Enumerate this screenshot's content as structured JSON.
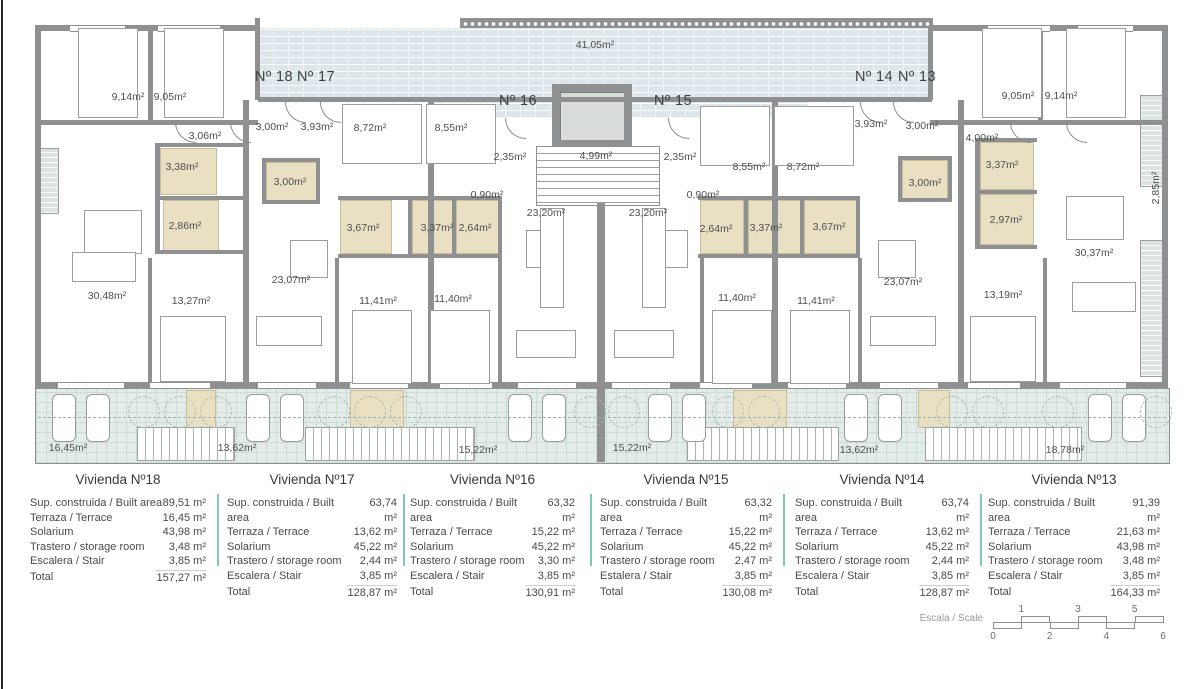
{
  "plan": {
    "labels": [
      {
        "t": "41,05m²",
        "x": 595,
        "y": 45
      },
      {
        "t": "Nº 18",
        "x": 274,
        "y": 77,
        "big": true
      },
      {
        "t": "Nº 17",
        "x": 316,
        "y": 77,
        "big": true
      },
      {
        "t": "Nº 16",
        "x": 518,
        "y": 101,
        "big": true
      },
      {
        "t": "Nº 15",
        "x": 673,
        "y": 101,
        "big": true
      },
      {
        "t": "Nº 14",
        "x": 874,
        "y": 77,
        "big": true
      },
      {
        "t": "Nº 13",
        "x": 917,
        "y": 77,
        "big": true
      },
      {
        "t": "9,14m²",
        "x": 128,
        "y": 97
      },
      {
        "t": "9,05m²",
        "x": 170,
        "y": 97
      },
      {
        "t": "3,06m²",
        "x": 205,
        "y": 136
      },
      {
        "t": "3,00m²",
        "x": 272,
        "y": 127
      },
      {
        "t": "3,93m²",
        "x": 317,
        "y": 127
      },
      {
        "t": "8,72m²",
        "x": 370,
        "y": 128
      },
      {
        "t": "8,55m²",
        "x": 451,
        "y": 128
      },
      {
        "t": "2,35m²",
        "x": 510,
        "y": 157
      },
      {
        "t": "4,99m²",
        "x": 596,
        "y": 156
      },
      {
        "t": "2,35m²",
        "x": 680,
        "y": 157
      },
      {
        "t": "8,55m²",
        "x": 749,
        "y": 167
      },
      {
        "t": "8,72m²",
        "x": 803,
        "y": 167
      },
      {
        "t": "3,93m²",
        "x": 871,
        "y": 124
      },
      {
        "t": "3,00m²",
        "x": 922,
        "y": 126
      },
      {
        "t": "4,00m²",
        "x": 982,
        "y": 138
      },
      {
        "t": "9,05m²",
        "x": 1018,
        "y": 96
      },
      {
        "t": "9,14m²",
        "x": 1061,
        "y": 96
      },
      {
        "t": "3,38m²",
        "x": 182,
        "y": 167
      },
      {
        "t": "3,00m²",
        "x": 290,
        "y": 182
      },
      {
        "t": "2,86m²",
        "x": 185,
        "y": 226
      },
      {
        "t": "3,67m²",
        "x": 363,
        "y": 228
      },
      {
        "t": "3,37m²",
        "x": 437,
        "y": 228
      },
      {
        "t": "2,64m²",
        "x": 475,
        "y": 228
      },
      {
        "t": "0,90m²",
        "x": 487,
        "y": 195
      },
      {
        "t": "23,20m²",
        "x": 546,
        "y": 213
      },
      {
        "t": "23,20m²",
        "x": 648,
        "y": 213
      },
      {
        "t": "0,90m²",
        "x": 703,
        "y": 195
      },
      {
        "t": "2,64m²",
        "x": 716,
        "y": 229
      },
      {
        "t": "3,37m²",
        "x": 766,
        "y": 228
      },
      {
        "t": "3,67m²",
        "x": 829,
        "y": 227
      },
      {
        "t": "3,37m²",
        "x": 1002,
        "y": 165
      },
      {
        "t": "3,00m²",
        "x": 925,
        "y": 183
      },
      {
        "t": "2,97m²",
        "x": 1006,
        "y": 220
      },
      {
        "t": "30,48m²",
        "x": 107,
        "y": 296
      },
      {
        "t": "13,27m²",
        "x": 191,
        "y": 301
      },
      {
        "t": "23,07m²",
        "x": 291,
        "y": 280
      },
      {
        "t": "11,41m²",
        "x": 378,
        "y": 301
      },
      {
        "t": "11,40m²",
        "x": 453,
        "y": 299
      },
      {
        "t": "11,40m²",
        "x": 737,
        "y": 298
      },
      {
        "t": "11,41m²",
        "x": 816,
        "y": 301
      },
      {
        "t": "23,07m²",
        "x": 903,
        "y": 282
      },
      {
        "t": "13,19m²",
        "x": 1003,
        "y": 295
      },
      {
        "t": "30,37m²",
        "x": 1094,
        "y": 253
      },
      {
        "t": "2,85m²",
        "x": 1156,
        "y": 188,
        "v": true
      },
      {
        "t": "16,45m²",
        "x": 68,
        "y": 448
      },
      {
        "t": "13,62m²",
        "x": 237,
        "y": 448
      },
      {
        "t": "15,22m²",
        "x": 478,
        "y": 450
      },
      {
        "t": "15,22m²",
        "x": 632,
        "y": 448
      },
      {
        "t": "13,62m²",
        "x": 859,
        "y": 450
      },
      {
        "t": "18,78m²",
        "x": 1065,
        "y": 450
      }
    ]
  },
  "units": [
    {
      "title": "Vivienda Nº18",
      "rows": [
        [
          "Sup. construida / Built area",
          "89,51 m²"
        ],
        [
          "Terraza / Terrace",
          "16,45 m²"
        ],
        [
          "Solarium",
          "43,98 m²"
        ],
        [
          "Trastero / storage room",
          "3,48 m²"
        ],
        [
          "Escalera / Stair",
          "3,85 m²"
        ],
        [
          "Total",
          "157,27 m²"
        ]
      ]
    },
    {
      "title": "Vivienda Nº17",
      "rows": [
        [
          "Sup. construida / Built area",
          "63,74 m²"
        ],
        [
          "Terraza / Terrace",
          "13,62 m²"
        ],
        [
          "Solarium",
          "45,22 m²"
        ],
        [
          "Trastero / storage room",
          "2,44 m²"
        ],
        [
          "Escalera / Stair",
          "3,85 m²"
        ],
        [
          "Total",
          "128,87 m²"
        ]
      ]
    },
    {
      "title": "Vivienda Nº16",
      "rows": [
        [
          "Sup. construida / Built area",
          "63,32 m²"
        ],
        [
          "Terraza / Terrace",
          "15,22 m²"
        ],
        [
          "Solarium",
          "45,22 m²"
        ],
        [
          "Trastero / storage room",
          "3,30 m²"
        ],
        [
          "Escalera / Stair",
          "3,85 m²"
        ],
        [
          "Total",
          "130,91 m²"
        ]
      ]
    },
    {
      "title": "Vivienda Nº15",
      "rows": [
        [
          "Sup. construida / Built area",
          "63,32 m²"
        ],
        [
          "Terraza / Terrace",
          "15,22 m²"
        ],
        [
          "Solarium",
          "45,22 m²"
        ],
        [
          "Trastero / storage room",
          "2,47 m²"
        ],
        [
          "Estalera / Stair",
          "3,85 m²"
        ],
        [
          "Total",
          "130,08 m²"
        ]
      ]
    },
    {
      "title": "Vivienda Nº14",
      "rows": [
        [
          "Sup. construida / Built area",
          "63,74 m²"
        ],
        [
          "Terraza / Terrace",
          "13,62 m²"
        ],
        [
          "Solarium",
          "45,22 m²"
        ],
        [
          "Trastero / storage room",
          "2,44 m²"
        ],
        [
          "Escalera / Stair",
          "3,85 m²"
        ],
        [
          "Total",
          "128,87 m²"
        ]
      ]
    },
    {
      "title": "Vivienda Nº13",
      "rows": [
        [
          "Sup. construida / Built area",
          "91,39 m²"
        ],
        [
          "Terraza / Terrace",
          "21,63 m²"
        ],
        [
          "Solarium",
          "43,98 m²"
        ],
        [
          "Trastero / storage room",
          "3,48 m²"
        ],
        [
          "Escalera / Stair",
          "3,85 m²"
        ],
        [
          "Total",
          "164,33 m²"
        ]
      ]
    }
  ],
  "scale": {
    "label": "Escala / Scale",
    "top_numbers": [
      "1",
      "3",
      "5"
    ],
    "bottom_numbers": [
      "0",
      "2",
      "4",
      "6"
    ]
  },
  "colors": {
    "wall": "#8e9092",
    "corridor_hatch": "#dde6ea",
    "terrace": "#e3ece8",
    "bathroom": "#e9e0c3",
    "table_separator": "#7fc9bb"
  }
}
